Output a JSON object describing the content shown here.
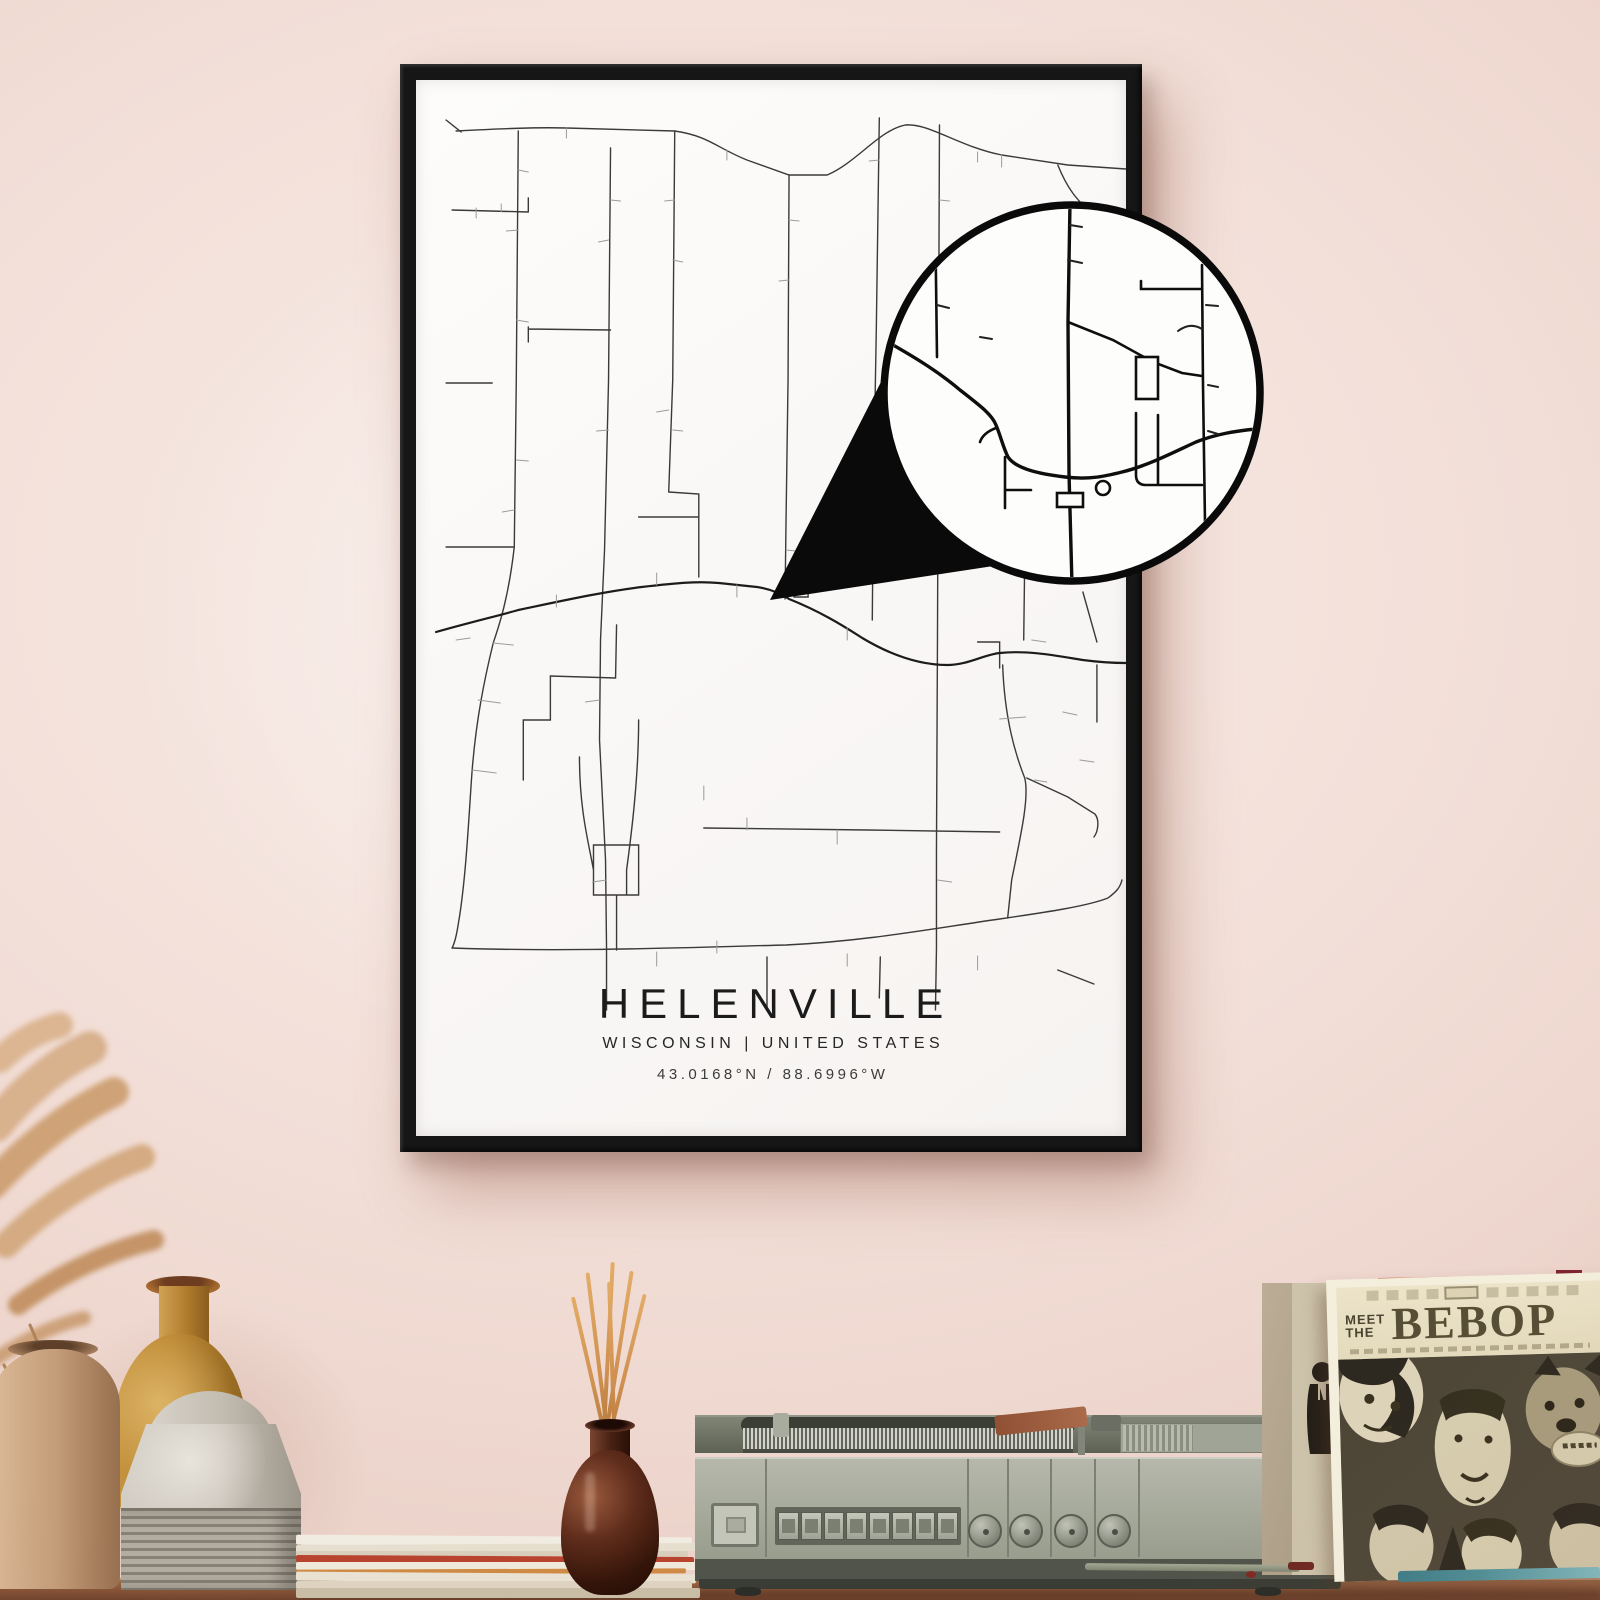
{
  "poster": {
    "title": "HELENVILLE",
    "subtitle": "WISCONSIN | UNITED STATES",
    "coordinates": "43.0168°N / 88.6996°W"
  },
  "album": {
    "pretitle_line1": "MEET",
    "pretitle_line2": "THE",
    "title": "BEBOP"
  },
  "theme": {
    "wall-top": "#e7cabf",
    "wall-center": "#f8ece7",
    "frame": "#161616",
    "paper": "#fcfbfa",
    "ink": "#1b1b1b",
    "road-dark": "#1c1c1c",
    "road-mid": "#3a3a3a",
    "road-light": "#9b9b9b",
    "table-light": "#a06c4b",
    "table-dark": "#6f432c",
    "player-body": "#b5b8ab",
    "album-cream": "#e4dabc",
    "album-ink": "#564e35",
    "album-art-bg": "#4e4738",
    "teal": "#4f8f97",
    "incense": "#351509",
    "stick": "#cf9050",
    "vase-tan": "#c49d7a",
    "vase-mustard": "#bd8a35",
    "vase-gray": "#c6c0b6",
    "red-sleeve": "#b85c35"
  }
}
